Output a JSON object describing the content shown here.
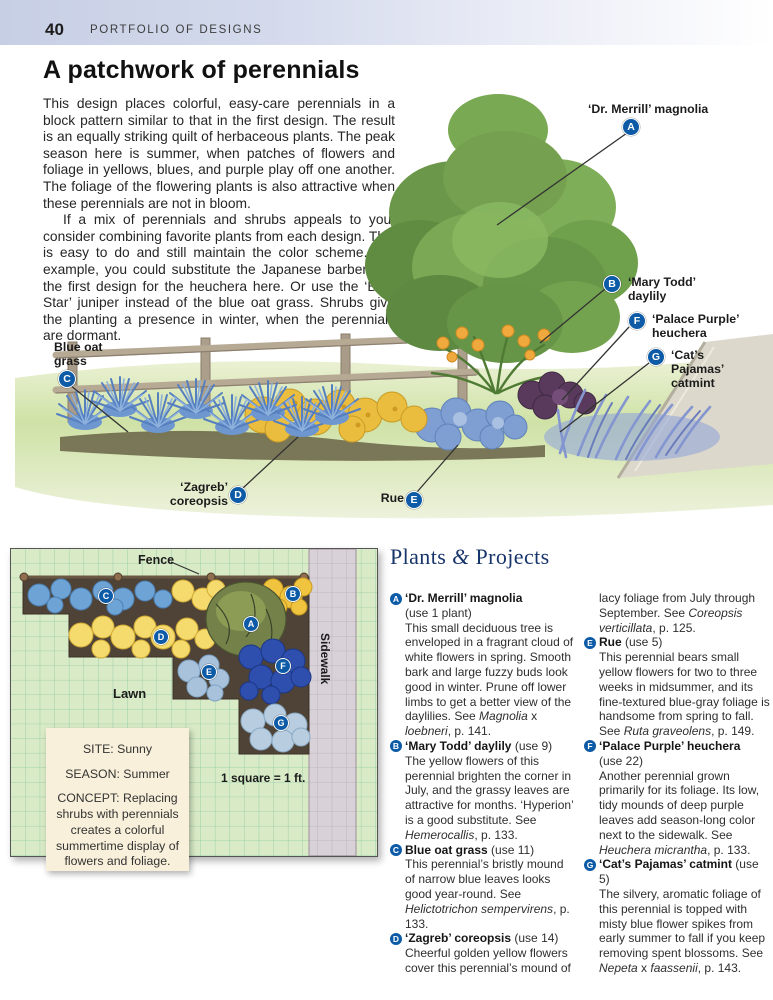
{
  "page": {
    "number": "40",
    "section": "PORTFOLIO OF DESIGNS",
    "title": "A patchwork of perennials"
  },
  "intro": {
    "p1": "This design places colorful, easy-care perennials in a block pattern similar to that in the first design. The result is an equally striking quilt of herbaceous plants. The peak season here is summer, when patches of flowers and foliage in yellows, blues, and purple play off one another. The foliage of the flowering plants is also attractive when these perennials are not in bloom.",
    "p2": "If a mix of perennials and shrubs appeals to you, consider combining favorite plants from each design. This is easy to do and still maintain the color scheme. For example, you could substitute the Japanese barberry in the first design for the heuchera here. Or use the ‘Blue Star’ juniper instead of the blue oat grass. Shrubs give the planting a presence in winter, when the perennials are dormant."
  },
  "illustration": {
    "callouts": [
      {
        "letter": "A",
        "label": "‘Dr. Merrill’ magnolia"
      },
      {
        "letter": "B",
        "label": "‘Mary Todd’ daylily"
      },
      {
        "letter": "F",
        "label": "‘Palace Purple’ heuchera"
      },
      {
        "letter": "G",
        "label": "‘Cat’s Pajamas’ catmint"
      },
      {
        "letter": "C",
        "label": "Blue oat grass"
      },
      {
        "letter": "D",
        "label": "‘Zagreb’ coreopsis"
      },
      {
        "letter": "E",
        "label": "Rue"
      }
    ]
  },
  "plan": {
    "fence_label": "Fence",
    "lawn_label": "Lawn",
    "sidewalk_label": "Sidewalk",
    "scale_label": "1 square = 1 ft.",
    "markers": [
      {
        "letter": "A"
      },
      {
        "letter": "B"
      },
      {
        "letter": "C"
      },
      {
        "letter": "D"
      },
      {
        "letter": "E"
      },
      {
        "letter": "F"
      },
      {
        "letter": "G"
      }
    ],
    "site_box": {
      "site": "SITE: Sunny",
      "season": "SEASON: Summer",
      "concept": "CONCEPT: Replacing shrubs with perennials creates a colorful summertime display of flowers and foliage."
    }
  },
  "plants": {
    "heading_runs": [
      {
        "t": "Plants "
      },
      {
        "t": "&",
        "i": true
      },
      {
        "t": " Projects"
      }
    ],
    "col1": [
      {
        "letter": "A",
        "name": "‘Dr. Merrill’ magnolia",
        "use_below": "(use 1 plant)",
        "desc_runs": [
          {
            "t": "This small deciduous tree is enveloped in a fragrant cloud of white flowers in spring. Smooth bark and large fuzzy buds look good in winter. Prune off lower limbs to get a better view of the daylilies. See "
          },
          {
            "t": "Magnolia",
            "i": true
          },
          {
            "t": " x "
          },
          {
            "t": "loebneri",
            "i": true
          },
          {
            "t": ", p. 141."
          }
        ]
      },
      {
        "letter": "B",
        "name": "‘Mary Todd’ daylily",
        "use_inline": "(use 9)",
        "desc_runs": [
          {
            "t": "The yellow flowers of this perennial brighten the corner in July, and the grassy leaves are attractive for months. ‘Hyperion’ is a good substitute. See "
          },
          {
            "t": "Hemerocallis",
            "i": true
          },
          {
            "t": ", p. 133."
          }
        ]
      },
      {
        "letter": "C",
        "name": "Blue oat grass",
        "use_inline": "(use 11)",
        "desc_runs": [
          {
            "t": "This perennial’s bristly mound of narrow blue leaves looks good year-round. See "
          },
          {
            "t": "Helictotrichon sempervirens",
            "i": true
          },
          {
            "t": ", p. 133."
          }
        ]
      },
      {
        "letter": "D",
        "name": "‘Zagreb’ coreopsis",
        "use_inline": "(use 14)",
        "desc_runs": [
          {
            "t": "Cheerful golden yellow flowers cover this perennial’s mound of"
          }
        ]
      }
    ],
    "col2": [
      {
        "cont_runs": [
          {
            "t": "lacy foliage from July through September. See "
          },
          {
            "t": "Coreopsis verticillata",
            "i": true
          },
          {
            "t": ", p. 125."
          }
        ]
      },
      {
        "letter": "E",
        "name": "Rue",
        "use_inline": "(use 5)",
        "desc_runs": [
          {
            "t": "This perennial bears small yellow flowers for two to three weeks in midsummer, and its fine-textured blue-gray foliage is handsome from spring to fall. See "
          },
          {
            "t": "Ruta graveolens",
            "i": true
          },
          {
            "t": ", p. 149."
          }
        ]
      },
      {
        "letter": "F",
        "name": "‘Palace Purple’ heuchera",
        "use_below": "(use 22)",
        "desc_runs": [
          {
            "t": "Another perennial grown primarily for its foliage. Its low, tidy mounds of deep purple leaves add season-long color next to the sidewalk. See "
          },
          {
            "t": "Heuchera micrantha",
            "i": true
          },
          {
            "t": ", p. 133."
          }
        ]
      },
      {
        "letter": "G",
        "name": "‘Cat’s Pajamas’ catmint",
        "use_inline": "(use 5)",
        "desc_runs": [
          {
            "t": "The silvery, aromatic foliage of this perennial is topped with misty blue flower spikes from early summer to fall if you keep removing spent blossoms. See "
          },
          {
            "t": "Nepeta",
            "i": true
          },
          {
            "t": " x "
          },
          {
            "t": "faassenii",
            "i": true
          },
          {
            "t": ", p. 143."
          }
        ]
      }
    ]
  },
  "colors": {
    "marker_blue": "#0d5ba6",
    "heading_navy": "#17356b",
    "header_bar": "#c7cfe5",
    "plan_green": "#d9ebc6",
    "plan_grid": "#8cc8a4",
    "site_box_cream": "#f8f0da"
  }
}
